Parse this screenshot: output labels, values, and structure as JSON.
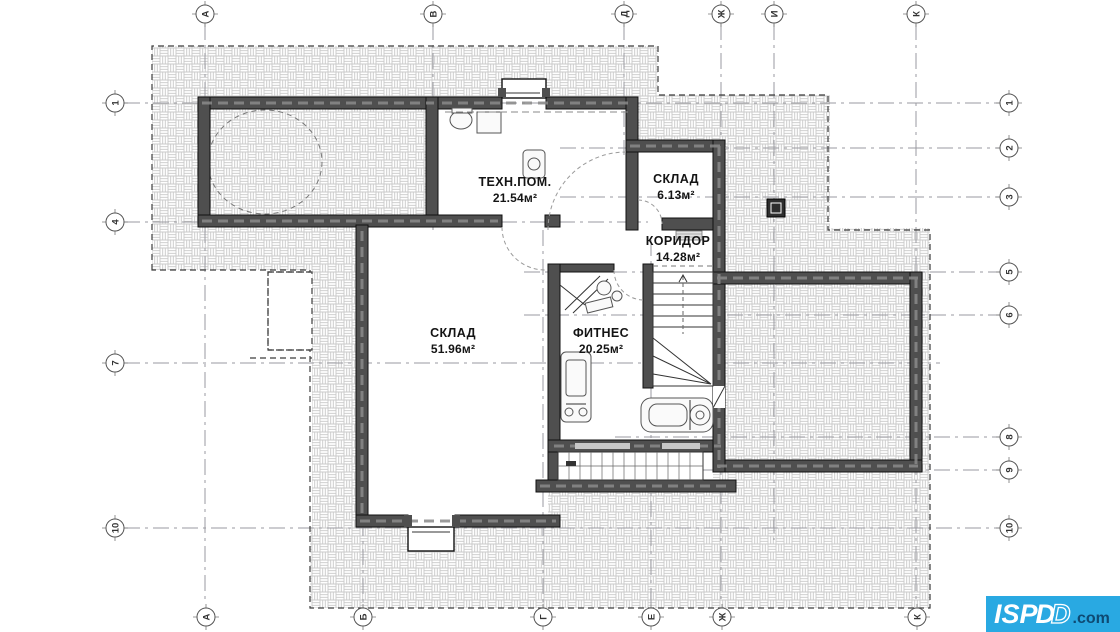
{
  "rooms": [
    {
      "name": "ТЕХН.ПОМ.",
      "area": "21.54м²"
    },
    {
      "name": "СКЛАД",
      "area": "6.13м²"
    },
    {
      "name": "КОРИДОР",
      "area": "14.28м²"
    },
    {
      "name": "СКЛАД",
      "area": "51.96м²"
    },
    {
      "name": "ФИТНЕС",
      "area": "20.25м²"
    }
  ],
  "grid": {
    "top": [
      {
        "label": "А"
      },
      {
        "label": "В"
      },
      {
        "label": "Д"
      },
      {
        "label": "Ж"
      },
      {
        "label": "И"
      },
      {
        "label": "К"
      }
    ],
    "bottom": [
      {
        "label": "А"
      },
      {
        "label": "Б"
      },
      {
        "label": "Г"
      },
      {
        "label": "Е"
      },
      {
        "label": "Ж"
      },
      {
        "label": "К"
      }
    ],
    "left": [
      {
        "label": "1"
      },
      {
        "label": "4"
      },
      {
        "label": "7"
      },
      {
        "label": "10"
      }
    ],
    "right": [
      {
        "label": "1"
      },
      {
        "label": "2"
      },
      {
        "label": "3"
      },
      {
        "label": "5"
      },
      {
        "label": "6"
      },
      {
        "label": "8"
      },
      {
        "label": "9"
      },
      {
        "label": "10"
      }
    ]
  },
  "logo": {
    "main": "ISP",
    "d_solid": "D",
    "d_outline": "D",
    "suffix": ".com",
    "bg_color": "#29a9e2",
    "suffix_color": "#0e4a73"
  },
  "colors": {
    "wall": "#4f4f4f",
    "hatch_line": "#c9c9c9",
    "grid_line": "#9a9aa0"
  }
}
